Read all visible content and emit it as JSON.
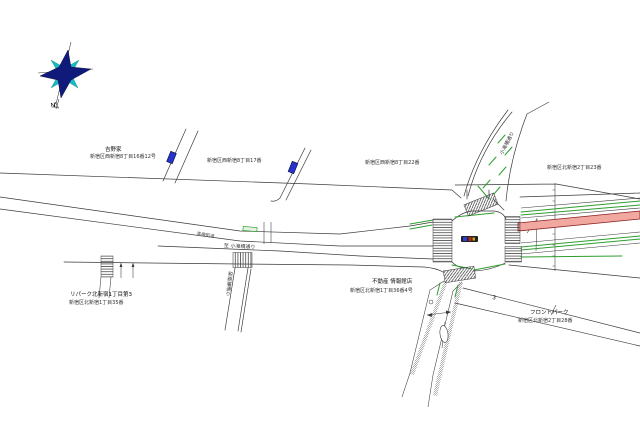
{
  "map": {
    "compass": {
      "north_label": "N"
    },
    "labels": {
      "yoshinoya": {
        "name": "吉野家",
        "address": "新宿区西新宿8丁目16番12号"
      },
      "nishishinjuku17": {
        "address": "新宿区西新宿8丁目17番"
      },
      "nishishinjuku22": {
        "address": "新宿区西新宿8丁目22番"
      },
      "kitashinjuku23": {
        "address": "新宿区北新宿2丁目23番"
      },
      "repark": {
        "name": "リパーク北新宿1丁目第3",
        "address": "新宿区北新宿1丁目35番"
      },
      "fudosan": {
        "name": "不動産 情報館店",
        "address": "新宿区北新宿1丁目36番4号"
      },
      "frontpark": {
        "name": "フロントパーク",
        "address": "新宿区北新宿2丁目28番"
      },
      "to_kotakibashi": {
        "text": "至 小滝橋通り"
      },
      "ome_kaido": {
        "text": "青梅街道"
      },
      "kotakibashi_dori": {
        "text": "小滝橋通り"
      },
      "zeimusho_dori": {
        "text": "税務署通り"
      },
      "block_number": {
        "text": "3"
      }
    },
    "colors": {
      "background": "#ffffff",
      "line": "#3a3a3a",
      "greenery": "#2f9e2f",
      "route_fill": "#f0a8a0",
      "route_edge": "#8b1f1f",
      "marker_blue": "#2633cc",
      "compass_navy": "#101a7a",
      "compass_cyan": "#17b8c8"
    }
  }
}
